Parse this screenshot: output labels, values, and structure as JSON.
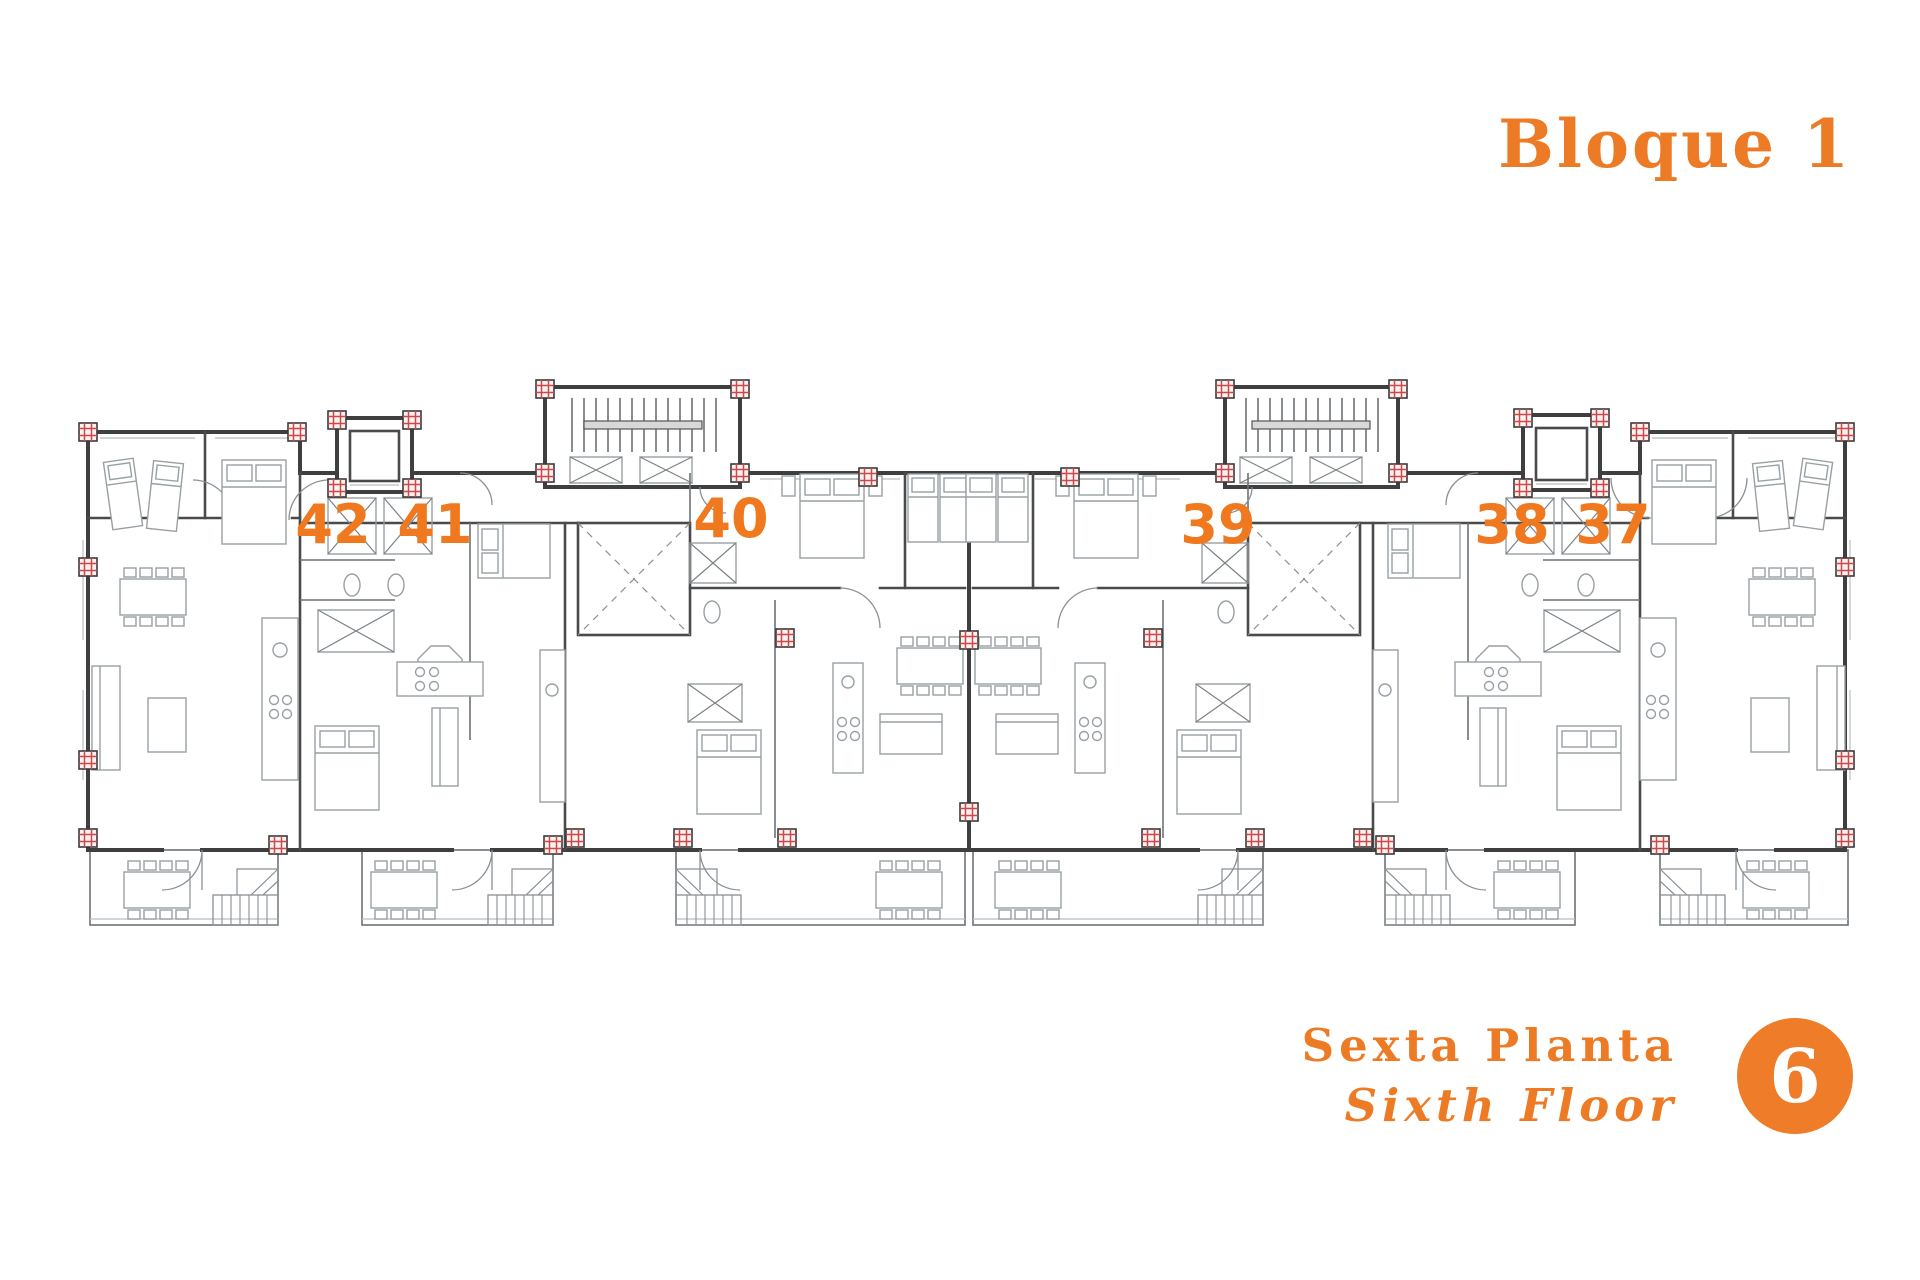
{
  "header": {
    "block_title": "Bloque 1"
  },
  "plan": {
    "units": [
      {
        "number": "42"
      },
      {
        "number": "41"
      },
      {
        "number": "40"
      },
      {
        "number": "39"
      },
      {
        "number": "38"
      },
      {
        "number": "37"
      }
    ]
  },
  "footer": {
    "floor_name_es": "Sexta Planta",
    "floor_name_en": "Sixth Floor",
    "badge_number": "6"
  },
  "colors": {
    "accent_orange": "#ED7B26",
    "unit_number_orange": "#F0781E",
    "wall_gray": "#3F3F3F",
    "furniture_gray": "#98A0A4",
    "column_red": "#C84A4A",
    "badge_fill": "#EE7C28",
    "badge_text": "#FFFFFF",
    "background": "#FFFFFF"
  },
  "icons": {
    "staircase-icon": "parallel tread lines with landing",
    "elevator-icon": "nested squares",
    "column-marker-icon": "small square with red hatch",
    "terrace-stairs-icon": "L-shaped tread grid with corner fan",
    "patio-shaft-icon": "square with dashed X",
    "floor-badge-icon": "solid orange circle"
  }
}
